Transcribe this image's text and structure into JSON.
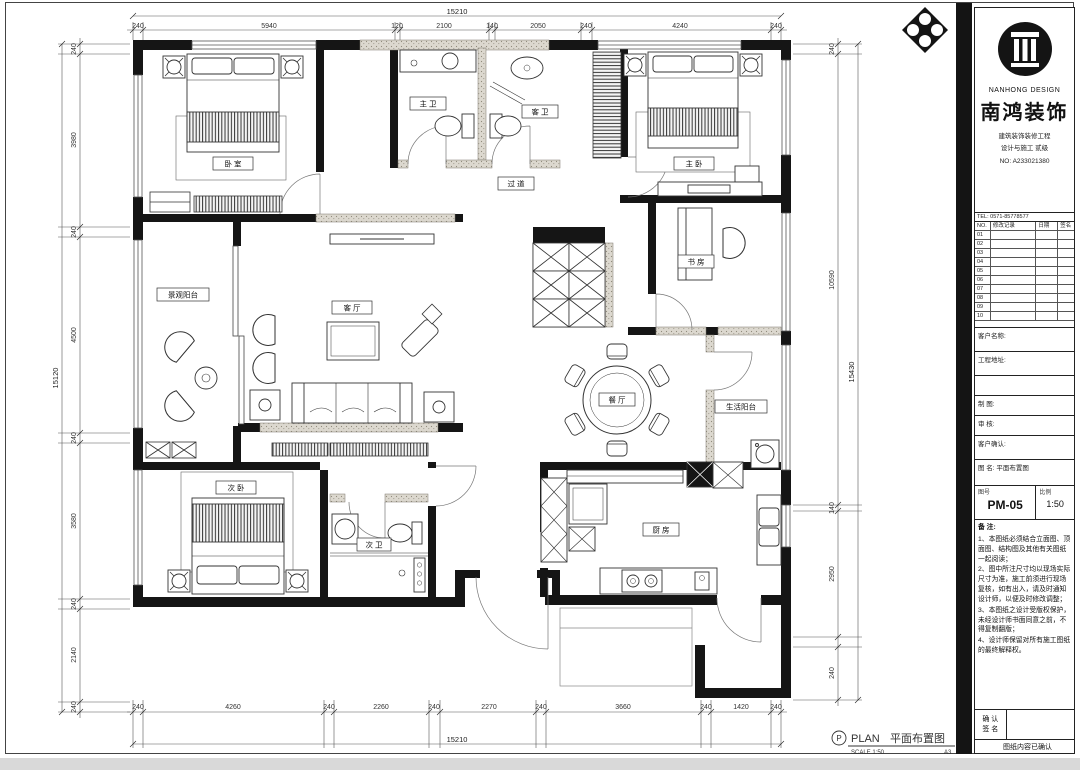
{
  "title_block": {
    "logo": {
      "en": "NANHONG DESIGN",
      "cn": "南鸿装饰"
    },
    "cert_lines": [
      "建筑装饰装修工程",
      "设计与施工 贰级",
      "NO: A233021380"
    ],
    "contact_line": "TEL: 0571-85778577",
    "revision_table": {
      "headers": [
        "NO.",
        "修改记录",
        "日期",
        "签名"
      ],
      "rows": [
        "01",
        "02",
        "03",
        "04",
        "05",
        "06",
        "07",
        "08",
        "09",
        "10"
      ]
    },
    "info_rows": [
      "客户名称:",
      "工程地址:",
      "设 计:",
      "制 图:",
      "审 核:",
      "客户确认:",
      "图 名: 平面布置图"
    ],
    "drawing_no_label": "图号",
    "drawing_no": "PM-05",
    "scale_label": "比例",
    "scale_value": "1:50",
    "notes_title": "备 注:",
    "notes": [
      "1、本图纸必须结合立面图、顶面图、结构图及其他有关图纸一起阅读；",
      "2、图中所注尺寸均以现场实际尺寸为准，施工前须进行现场复核，如有出入，请及时通知设计师，以便及时修改调整；",
      "3、本图纸之设计受版权保护，未经设计师书面同意之前，不得复制翻版；",
      "4、设计师保留对所有施工图纸的最终解释权。"
    ],
    "confirm_line1": "确 认",
    "confirm_line2": "签 名",
    "confirm_footer": "图纸内容已确认"
  },
  "plan": {
    "rooms": {
      "bedroom2": "卧 室",
      "master_bath": "主 卫",
      "guest_bath": "客 卫",
      "hallway": "过 道",
      "master_bedroom": "主 卧",
      "study": "书 房",
      "view_balcony": "景观阳台",
      "living": "客 厅",
      "dining": "餐 厅",
      "service_balcony": "生活阳台",
      "bedroom3": "次 卧",
      "second_bath": "次 卫",
      "kitchen": "厨 房"
    },
    "caption": {
      "marker": "P",
      "en": "PLAN",
      "cn": "平面布置图",
      "scale": "SCALE 1:50",
      "sheet": "A3"
    },
    "dims": {
      "top_total": "15210",
      "top": [
        "240",
        "5940",
        "120",
        "2100",
        "140",
        "2050",
        "240",
        "4240",
        "240"
      ],
      "bottom": [
        "240",
        "4260",
        "240",
        "2260",
        "240",
        "2270",
        "240",
        "3660",
        "240",
        "1420",
        "240"
      ],
      "bottom_total": "15210",
      "left": [
        "240",
        "3980",
        "240",
        "4500",
        "240",
        "3580",
        "240",
        "2140",
        "240"
      ],
      "left_total": "15120",
      "right": [
        "240",
        "10590",
        "140",
        "2950",
        "240"
      ],
      "right_total": "15430"
    }
  }
}
